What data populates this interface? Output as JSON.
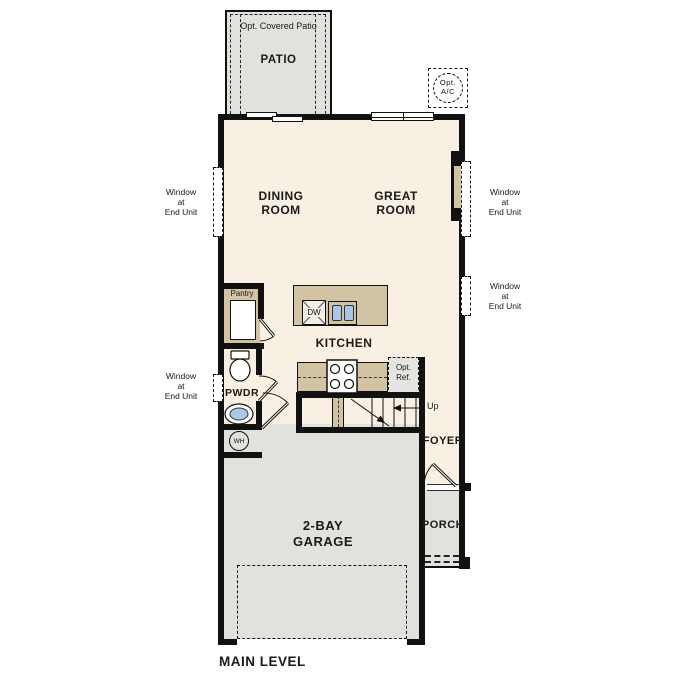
{
  "plan_title": "MAIN LEVEL",
  "rooms": {
    "patio": {
      "label": "PATIO",
      "roof_note": "Opt. Covered Patio"
    },
    "dining_room": {
      "label": "DINING\nROOM"
    },
    "great_room": {
      "label": "GREAT\nROOM"
    },
    "kitchen": {
      "label": "KITCHEN"
    },
    "pantry": {
      "label": "Pantry"
    },
    "powder_room": {
      "label": "PWDR"
    },
    "foyer": {
      "label": "FOYER"
    },
    "porch": {
      "label": "PORCH"
    },
    "garage": {
      "label": "2-BAY\nGARAGE"
    }
  },
  "fixtures": {
    "optional_ac": {
      "label": "Opt.\nA/C"
    },
    "dishwasher": {
      "label": "DW"
    },
    "optional_refrigerator": {
      "label": "Opt.\nRef."
    },
    "water_heater": {
      "label": "WH"
    },
    "stairs_direction": {
      "label": "Up"
    }
  },
  "annotations": {
    "window_at_end_unit": "Window\nat\nEnd Unit"
  },
  "colors": {
    "floor_cream": "#f7f0e3",
    "exterior_gray": "#e1e1dd",
    "casework_tan": "#d2c3a3",
    "fixture_blue": "#a9c7e9",
    "wall_black": "#111111"
  }
}
